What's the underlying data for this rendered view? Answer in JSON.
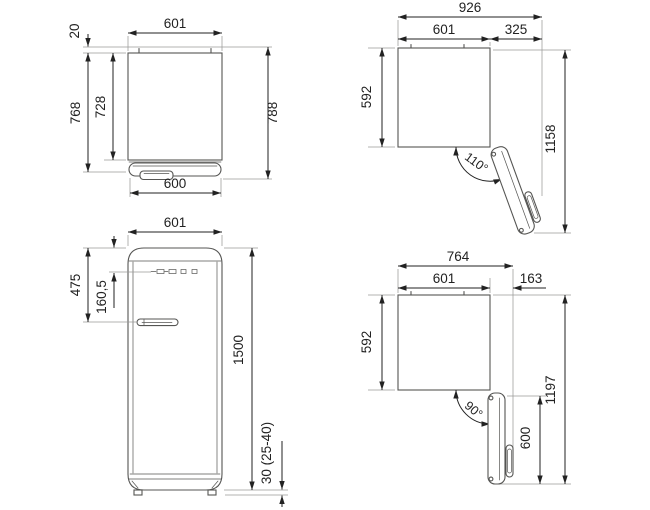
{
  "title": "Refrigerator dimension drawing (4 views)",
  "style": {
    "ink": "#222222",
    "outline": "#555553",
    "extension": "#9a9a98",
    "background": "#ffffff"
  },
  "views": {
    "top_closed": {
      "label": "top-view-door-closed",
      "dims": {
        "width_top": "601",
        "wall_clearance": "20",
        "depth_door": "768",
        "depth_body": "728",
        "depth_handle": "788",
        "width_front": "600"
      }
    },
    "top_open_110": {
      "label": "top-view-door-open-110",
      "dims": {
        "width_total": "926",
        "width_body": "601",
        "door_projection": "325",
        "depth_body": "592",
        "depth_total": "1158",
        "angle": "110°"
      }
    },
    "front": {
      "label": "front-view",
      "dims": {
        "width": "601",
        "handle_from_top": "475",
        "logo_from_top": "160,5",
        "height": "1500",
        "feet": "30 (25-40)"
      }
    },
    "top_open_90": {
      "label": "top-view-door-open-90",
      "dims": {
        "width_total": "764",
        "width_body": "601",
        "door_projection": "163",
        "depth_body": "592",
        "depth_total": "1197",
        "door_width": "600",
        "angle": "90°"
      }
    }
  }
}
